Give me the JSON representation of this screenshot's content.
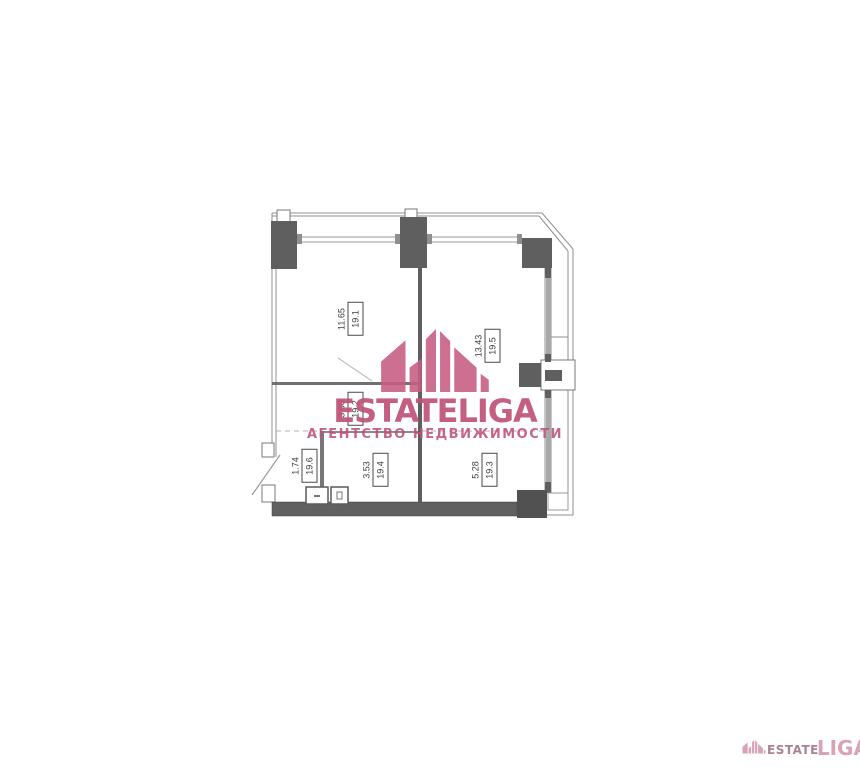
{
  "canvas": {
    "background": "#ffffff",
    "width": 860,
    "height": 768
  },
  "watermark": {
    "brand": "ESTATELIGA",
    "tagline": "АГЕНТСТВО НЕДВИЖИМОСТИ",
    "color": "#bf5277",
    "logo_icon": "skyline-buildings-icon"
  },
  "corner_logo": {
    "icon": "skyline-buildings-icon",
    "estate": "ESTATE",
    "liga": "LIGA",
    "estate_color": "#a8828e",
    "liga_color": "#d9a3b7"
  },
  "floorplan": {
    "type": "apartment-floor-plan",
    "wall_color": "#5f5f5f",
    "line_color": "#8f8f8f",
    "rooms": [
      {
        "id": "19.1",
        "area": "11.65"
      },
      {
        "id": "19.5",
        "area": "13.43"
      },
      {
        "id": "19.2",
        "area": "3.60"
      },
      {
        "id": "19.6",
        "area": "1.74"
      },
      {
        "id": "19.4",
        "area": "3.53"
      },
      {
        "id": "19.3",
        "area": "5.28"
      }
    ]
  }
}
